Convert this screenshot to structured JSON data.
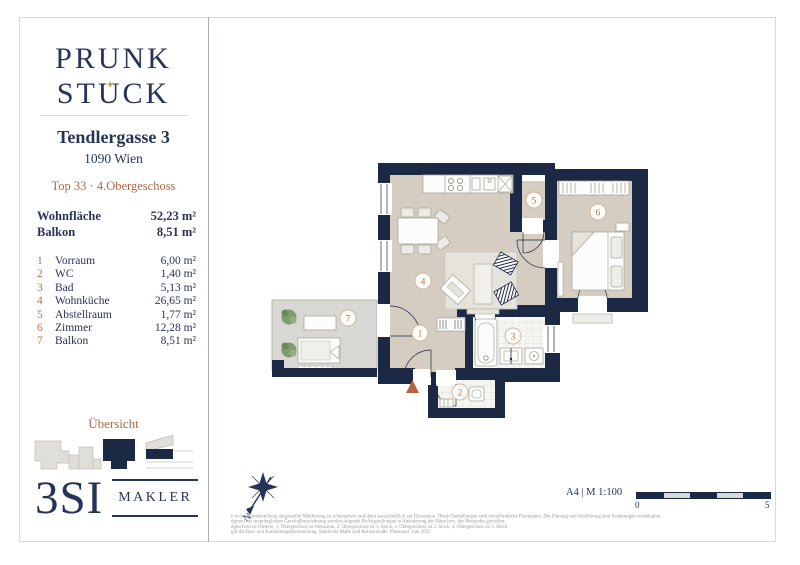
{
  "colors": {
    "navy": "#273459",
    "wall": "#1c2945",
    "copper": "#b06a45",
    "gold": "#c39a3f",
    "floor_tan": "#d5cdc1"
  },
  "sidebar": {
    "logo": {
      "line1": "PRUNK",
      "line2_left": "ST",
      "line2_mid": "U",
      "line2_right": "CK",
      "star": "✦"
    },
    "address": "Tendlergasse 3",
    "city": "1090 Wien",
    "unit": "Top 33 · 4.Obergeschoss",
    "summary": [
      {
        "label": "Wohnfläche",
        "value": "52,23 m²"
      },
      {
        "label": "Balkon",
        "value": "8,51 m²"
      }
    ],
    "rooms": [
      {
        "num": "1",
        "name": "Vorraum",
        "area": "6,00 m²"
      },
      {
        "num": "2",
        "name": "WC",
        "area": "1,40 m²"
      },
      {
        "num": "3",
        "name": "Bad",
        "area": "5,13 m²"
      },
      {
        "num": "4",
        "name": "Wohnküche",
        "area": "26,65 m²"
      },
      {
        "num": "5",
        "name": "Abstellraum",
        "area": "1,77 m²"
      },
      {
        "num": "6",
        "name": "Zimmer",
        "area": "12,28 m²"
      },
      {
        "num": "7",
        "name": "Balkon",
        "area": "8,51 m²"
      }
    ],
    "overview_label": "Übersicht",
    "agency": {
      "name": "3SI",
      "type": "MAKLER"
    }
  },
  "plan": {
    "north_label": "N",
    "format_scale": "A4 | M 1:100",
    "scalebar": {
      "start": "0",
      "end": "5"
    }
  },
  "footer_lines": [
    "e in der Plandarstellung dargestellte Möblierung ist schematisch und dient ausschließlich zur Illustration. Diese Darstellungen sind unverbindliche Plankopien. Der Planung und Ausführung sind Änderungen vorbehalten.",
    "dgrund der ursprünglichen Geschoßbezeichnung wurden folgende Richtigstellungen in Abänderung der Pläne bzw. des Bestandes getroffen:",
    "dgeschoss ist Parterre, 1. Obergeschoss ist Mezzanin, 2. Obergeschoss ist 1. Stock, 3. Obergeschoss ist 2. Stock, 4. Obergeschoss ist 3. Stock.",
    "gilt die Bau- und Ausstattungsbeschreibung. Sämtliche Maße sind Rohbaumaße. Planstand: Juni 2025"
  ]
}
